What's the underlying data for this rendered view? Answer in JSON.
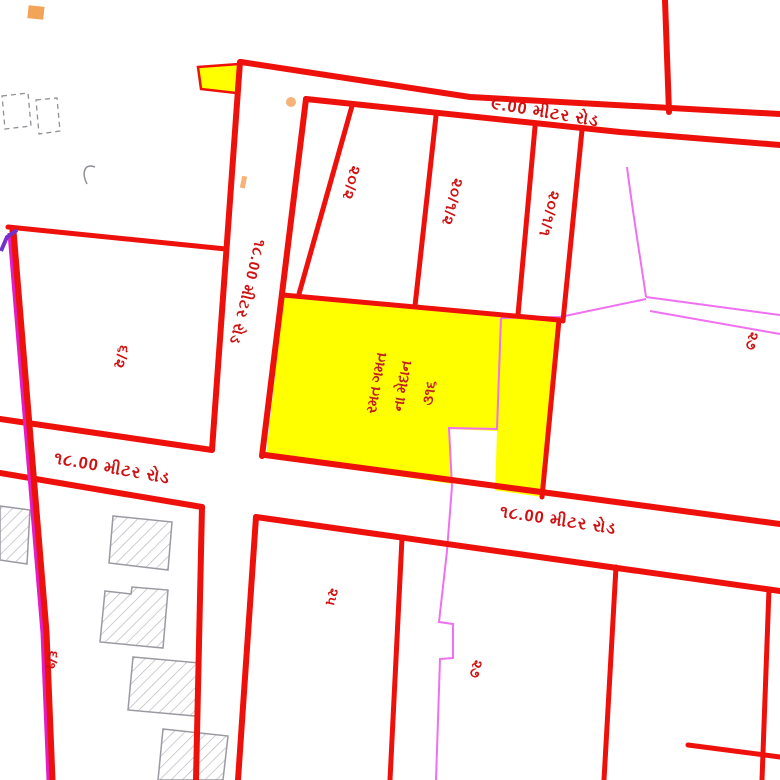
{
  "map": {
    "kind": "town-planning-cadastral-sheet",
    "language": "Gujarati",
    "background": "#ffffff",
    "colors": {
      "road_line": "#ee100a",
      "label_text": "#d01111",
      "highlight_fill": "#ffff00",
      "scheme_line_magenta": "#ef70f0",
      "boundary_magenta": "#e11ec4",
      "boundary_purple": "#7231cc",
      "building_outline": "#9a9aa2",
      "marker_orange": "#f2a458"
    },
    "roads": [
      {
        "id": "road-9m-top",
        "label": "૯.00 મીટર રોડ",
        "width_m": "9.00"
      },
      {
        "id": "road-18m-west",
        "label": "૧૮.00 મીટર રોડ",
        "width_m": "18.00"
      },
      {
        "id": "road-18m-south",
        "label": "૧૮.00 મીટર રોડ",
        "width_m": "18.00"
      },
      {
        "id": "road-18m-north-south",
        "label": "૧૮.00 મીટર રોડ",
        "width_m": "18.00"
      }
    ],
    "plots": [
      {
        "id": "plot-20-2",
        "label": "૨૦/૨"
      },
      {
        "id": "plot-20-1-2",
        "label": "૨૦/૧/૨"
      },
      {
        "id": "plot-20-1-1",
        "label": "૨૦/૧/૧"
      },
      {
        "id": "plot-6-2",
        "label": "૬/૨"
      },
      {
        "id": "plot-6-1",
        "label": "૬/૧"
      },
      {
        "id": "plot-25",
        "label": "૨૫"
      },
      {
        "id": "plot-27-east",
        "label": "૨૭"
      },
      {
        "id": "plot-27-south",
        "label": "૨૭"
      }
    ],
    "highlighted_plot": {
      "fill": "#ffff00",
      "lines": [
        "રમત ગમત",
        "ના મેદાન",
        "૩૧૬"
      ]
    }
  }
}
